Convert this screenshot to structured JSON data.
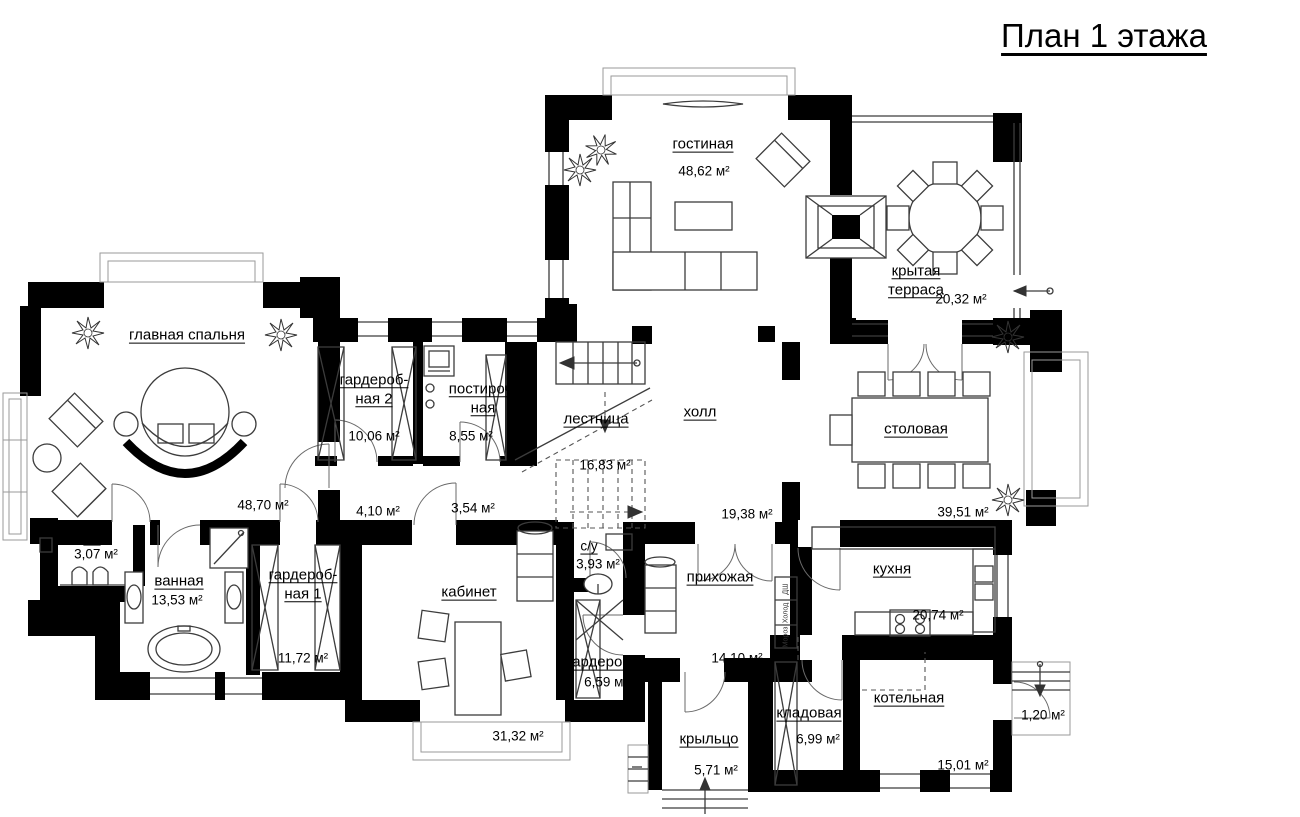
{
  "title": "План 1 этажа",
  "units": "м²",
  "colors": {
    "wall": "#000000",
    "line": "#3c3c3c",
    "background": "#ffffff"
  },
  "rooms": [
    {
      "name": "гостиная",
      "area": "48,62 м²"
    },
    {
      "name": "крытая\nтерраса",
      "area": "20,32 м²"
    },
    {
      "name": "главная спальня",
      "area": "48,70 м²"
    },
    {
      "name": "гардероб-\nная 2",
      "area": "10,06 м²"
    },
    {
      "name": "постироч-\nная",
      "area": "8,55 м²"
    },
    {
      "name": "лестница",
      "area": "16,83 м²"
    },
    {
      "name": "холл",
      "area": "19,38 м²"
    },
    {
      "name": "столовая",
      "area": "39,51 м²"
    },
    {
      "name": "с/у",
      "area": "3,07 м²"
    },
    {
      "name": "ванная",
      "area": "13,53 м²"
    },
    {
      "name": "гардероб-\nная 1",
      "area": "11,72 м²"
    },
    {
      "name": "кабинет",
      "area": "31,32 м²"
    },
    {
      "name": "с/у",
      "area": "3,93 м²"
    },
    {
      "name": "гардероб",
      "area": "6,59 м²"
    },
    {
      "name": "прихожая",
      "area": "14,10 м²"
    },
    {
      "name": "кухня",
      "area": "20,74 м²"
    },
    {
      "name": "кладовая",
      "area": "6,99 м²"
    },
    {
      "name": "котельная",
      "area": "15,01 м²"
    },
    {
      "name": "крыльцо",
      "area": "5,71 м²"
    },
    {
      "name": "",
      "area": "1,20 м²"
    },
    {
      "name": "",
      "area": "4,10 м²"
    },
    {
      "name": "",
      "area": "3,54 м²"
    }
  ],
  "appliances": [
    "ДШ",
    "Холод",
    "Мороз"
  ]
}
